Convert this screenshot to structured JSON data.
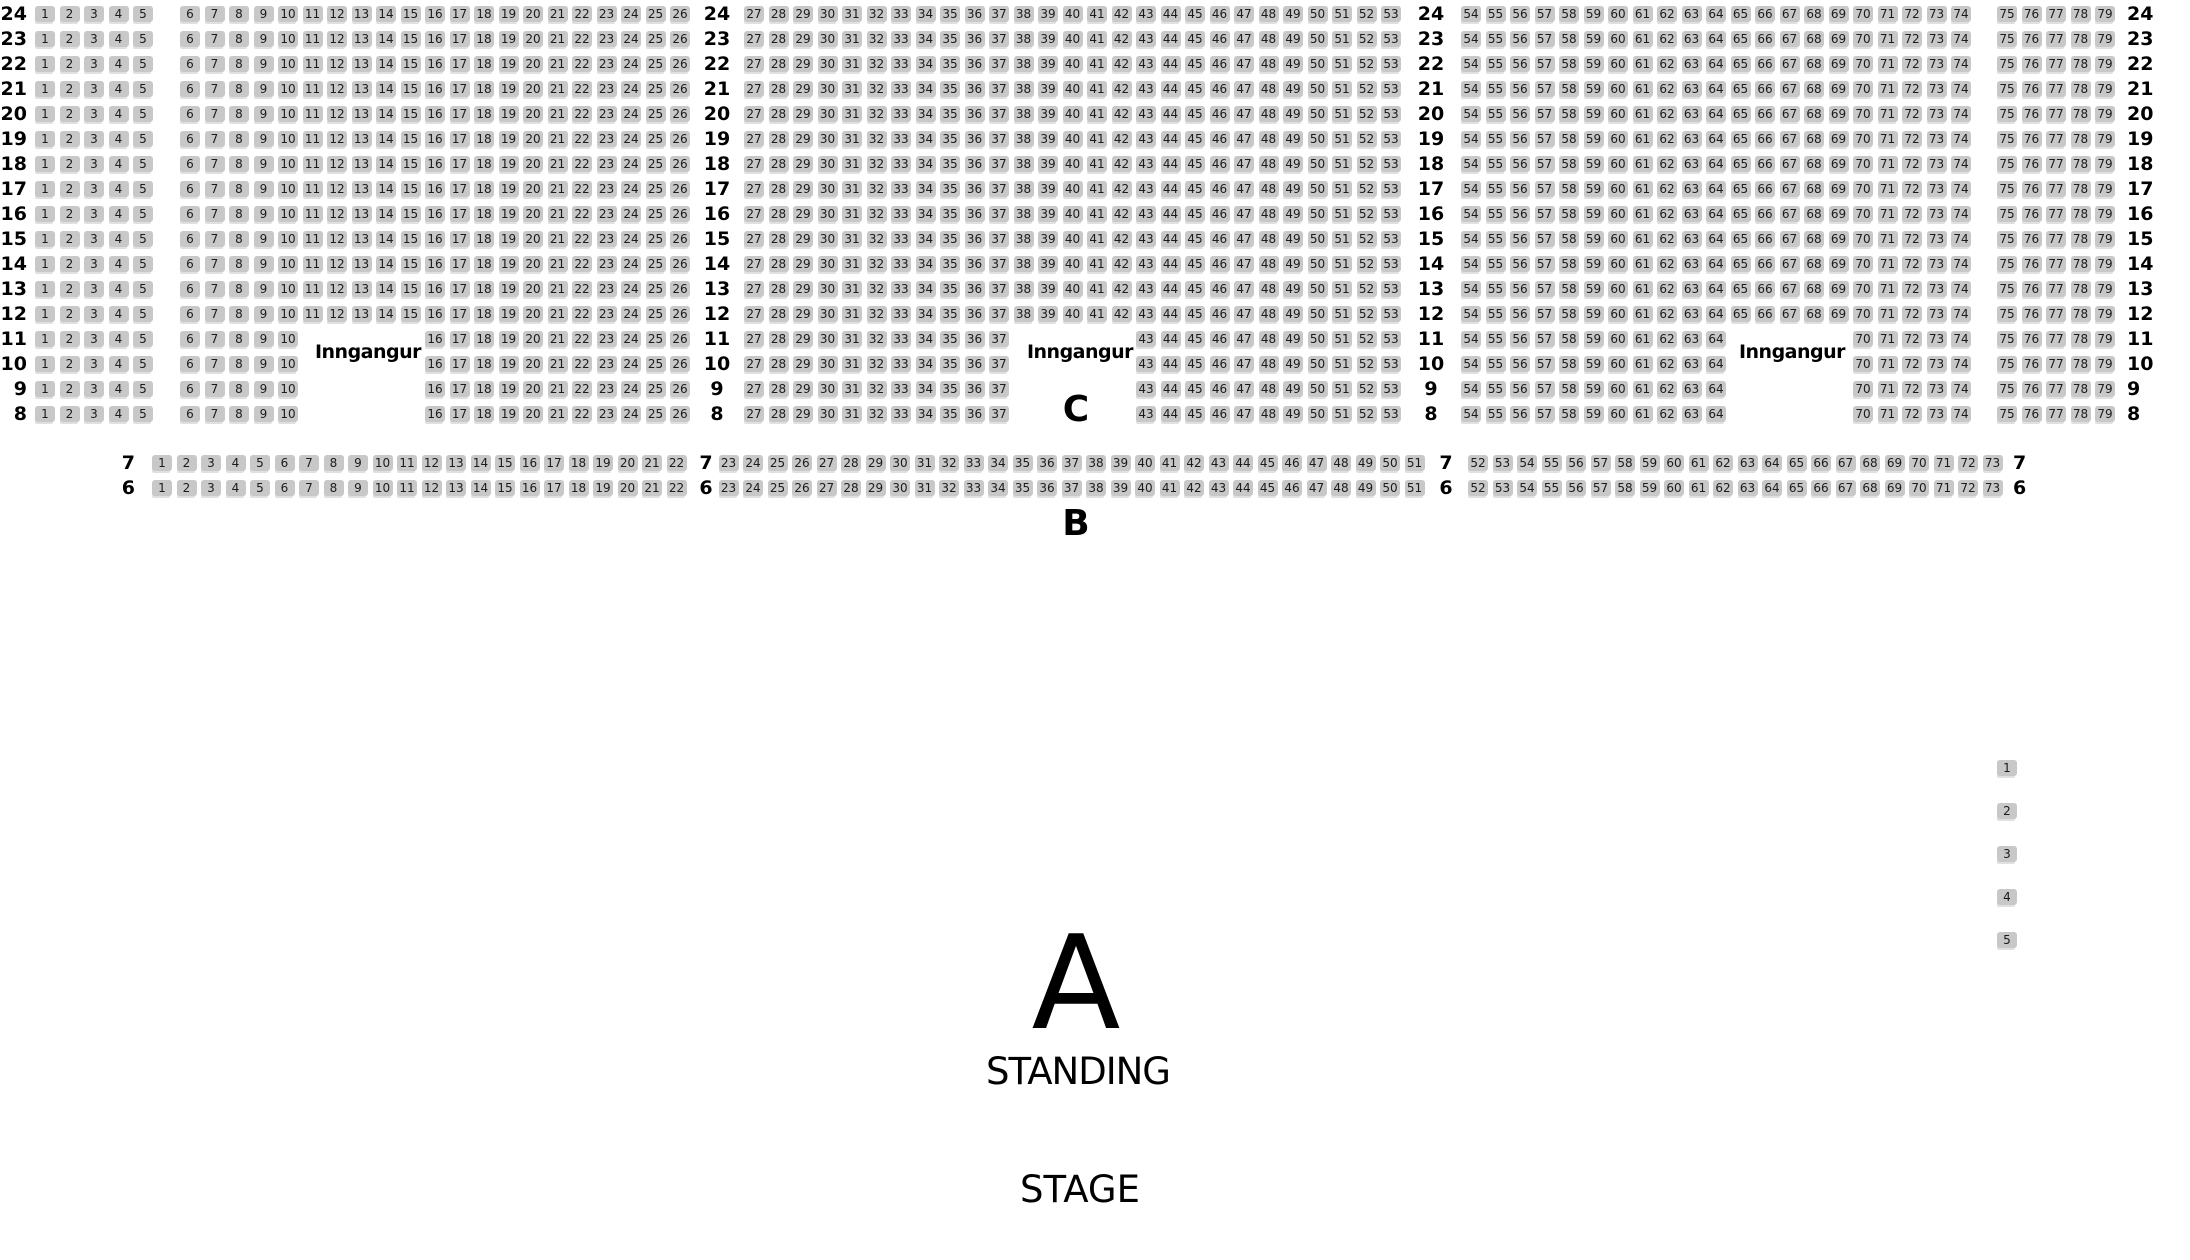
{
  "labels": {
    "entrance": "Inngangur",
    "section_a": "A",
    "section_b": "B",
    "section_c": "C",
    "standing": "STANDING",
    "stage": "STAGE"
  },
  "colors": {
    "seat_fill": "#c8c8c8",
    "seat_shadow": "#e0e0e0",
    "seat_number": "#1b1b1b",
    "label_text": "#000000"
  },
  "seat_map": {
    "main_section": {
      "section": "C",
      "rows": [
        {
          "row": 24,
          "blocks": [
            [
              1,
              5
            ],
            [
              6,
              26
            ],
            [
              27,
              53
            ],
            [
              54,
              74
            ],
            [
              75,
              79
            ]
          ]
        },
        {
          "row": 23,
          "blocks": [
            [
              1,
              5
            ],
            [
              6,
              26
            ],
            [
              27,
              53
            ],
            [
              54,
              74
            ],
            [
              75,
              79
            ]
          ]
        },
        {
          "row": 22,
          "blocks": [
            [
              1,
              5
            ],
            [
              6,
              26
            ],
            [
              27,
              53
            ],
            [
              54,
              74
            ],
            [
              75,
              79
            ]
          ]
        },
        {
          "row": 21,
          "blocks": [
            [
              1,
              5
            ],
            [
              6,
              26
            ],
            [
              27,
              53
            ],
            [
              54,
              74
            ],
            [
              75,
              79
            ]
          ]
        },
        {
          "row": 20,
          "blocks": [
            [
              1,
              5
            ],
            [
              6,
              26
            ],
            [
              27,
              53
            ],
            [
              54,
              74
            ],
            [
              75,
              79
            ]
          ]
        },
        {
          "row": 19,
          "blocks": [
            [
              1,
              5
            ],
            [
              6,
              26
            ],
            [
              27,
              53
            ],
            [
              54,
              74
            ],
            [
              75,
              79
            ]
          ]
        },
        {
          "row": 18,
          "blocks": [
            [
              1,
              5
            ],
            [
              6,
              26
            ],
            [
              27,
              53
            ],
            [
              54,
              74
            ],
            [
              75,
              79
            ]
          ]
        },
        {
          "row": 17,
          "blocks": [
            [
              1,
              5
            ],
            [
              6,
              26
            ],
            [
              27,
              53
            ],
            [
              54,
              74
            ],
            [
              75,
              79
            ]
          ]
        },
        {
          "row": 16,
          "blocks": [
            [
              1,
              5
            ],
            [
              6,
              26
            ],
            [
              27,
              53
            ],
            [
              54,
              74
            ],
            [
              75,
              79
            ]
          ]
        },
        {
          "row": 15,
          "blocks": [
            [
              1,
              5
            ],
            [
              6,
              26
            ],
            [
              27,
              53
            ],
            [
              54,
              74
            ],
            [
              75,
              79
            ]
          ]
        },
        {
          "row": 14,
          "blocks": [
            [
              1,
              5
            ],
            [
              6,
              26
            ],
            [
              27,
              53
            ],
            [
              54,
              74
            ],
            [
              75,
              79
            ]
          ]
        },
        {
          "row": 13,
          "blocks": [
            [
              1,
              5
            ],
            [
              6,
              26
            ],
            [
              27,
              53
            ],
            [
              54,
              74
            ],
            [
              75,
              79
            ]
          ]
        },
        {
          "row": 12,
          "blocks": [
            [
              1,
              5
            ],
            [
              6,
              26
            ],
            [
              27,
              53
            ],
            [
              54,
              74
            ],
            [
              75,
              79
            ]
          ]
        },
        {
          "row": 11,
          "blocks": [
            [
              1,
              5
            ],
            [
              6,
              10
            ],
            [
              16,
              26
            ],
            [
              27,
              37
            ],
            [
              43,
              53
            ],
            [
              54,
              64
            ],
            [
              70,
              74
            ],
            [
              75,
              79
            ]
          ]
        },
        {
          "row": 10,
          "blocks": [
            [
              1,
              5
            ],
            [
              6,
              10
            ],
            [
              16,
              26
            ],
            [
              27,
              37
            ],
            [
              43,
              53
            ],
            [
              54,
              64
            ],
            [
              70,
              74
            ],
            [
              75,
              79
            ]
          ]
        },
        {
          "row": 9,
          "blocks": [
            [
              1,
              5
            ],
            [
              6,
              10
            ],
            [
              16,
              26
            ],
            [
              27,
              37
            ],
            [
              43,
              53
            ],
            [
              54,
              64
            ],
            [
              70,
              74
            ],
            [
              75,
              79
            ]
          ]
        },
        {
          "row": 8,
          "blocks": [
            [
              1,
              5
            ],
            [
              6,
              10
            ],
            [
              16,
              26
            ],
            [
              27,
              37
            ],
            [
              43,
              53
            ],
            [
              54,
              64
            ],
            [
              70,
              74
            ],
            [
              75,
              79
            ]
          ]
        }
      ]
    },
    "b_section": {
      "section": "B",
      "rows": [
        {
          "row": 7,
          "blocks": [
            [
              1,
              22
            ],
            [
              23,
              51
            ],
            [
              52,
              73
            ]
          ]
        },
        {
          "row": 6,
          "blocks": [
            [
              1,
              22
            ],
            [
              23,
              51
            ],
            [
              52,
              73
            ]
          ]
        }
      ]
    },
    "side_column": {
      "seats": [
        1,
        2,
        3,
        4,
        5
      ]
    }
  }
}
